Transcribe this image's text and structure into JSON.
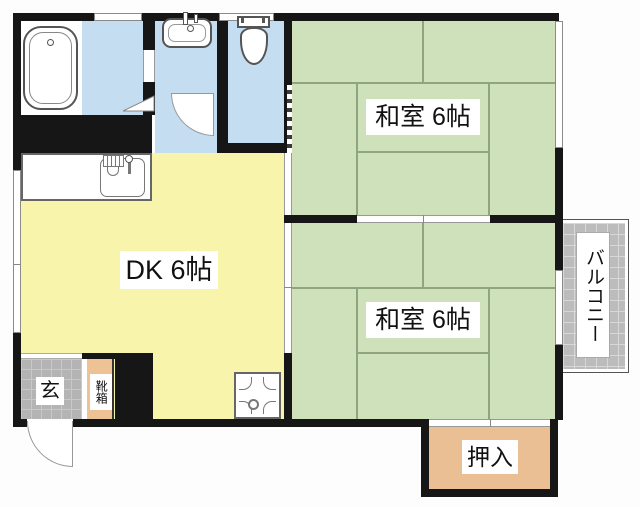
{
  "plan_title": "apartment-floor-plan",
  "rooms": {
    "dk": {
      "label": "DK 6帖"
    },
    "washitsu_upper": {
      "label": "和室 6帖"
    },
    "washitsu_lower": {
      "label": "和室 6帖"
    },
    "oshiire": {
      "label": "押入"
    },
    "genkan": {
      "label": "玄"
    },
    "shoebox": {
      "label": "靴箱"
    },
    "balcony": {
      "label": "バルコニー"
    }
  },
  "colors": {
    "wall": "#161616",
    "tatami": "#cfe1ba",
    "tatami-line": "#8fa57e",
    "dk": "#f8f4ac",
    "water": "#c5ddf1",
    "closet": "#eabf93",
    "shoebox": "#edc295",
    "tile": "#b4b4b4",
    "balcony-tile": "#bcbcbc"
  }
}
